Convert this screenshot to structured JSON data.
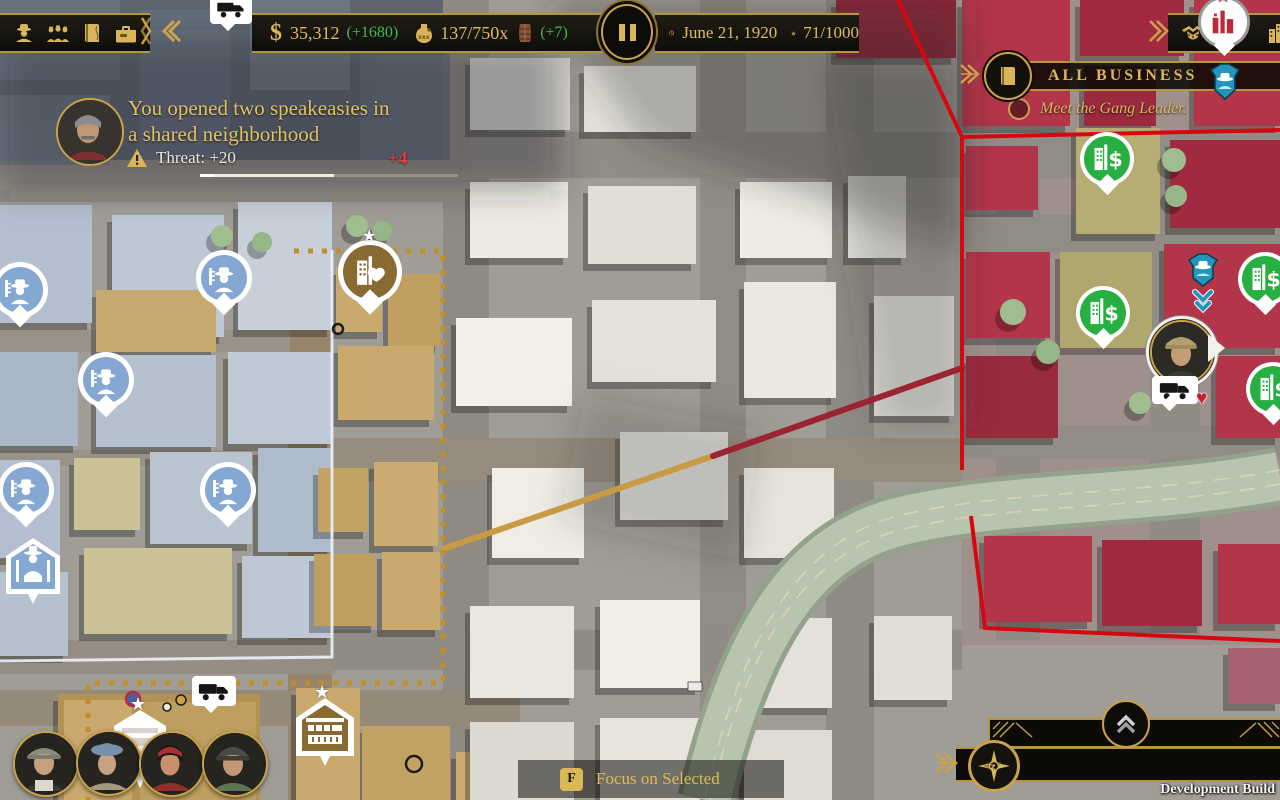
{
  "colors": {
    "gold": "#d4b056",
    "gold_bright": "#eacd7e",
    "green": "#43b854",
    "red_delta": "#e23c3c",
    "territory_red": "#d50812",
    "territory_blue": "#e9f0f7",
    "territory_gold": "#c08f2a",
    "pin_blue": "#84a8d2",
    "pin_green": "#27af41",
    "teal": "#2ba3c4"
  },
  "icons": {
    "star": "★",
    "heart": "♥",
    "dollar": "$",
    "warning": "!"
  },
  "top_bar": {
    "money_symbol": "$",
    "money_value": "35,312",
    "money_delta": "(+1680)",
    "booze_value": "137/750x",
    "booze_delta": "(+7)",
    "date": "June 21, 1920",
    "respect": "71/1000"
  },
  "notification": {
    "line1": "You opened two speakeasies in",
    "line2": "a shared neighborhood",
    "threat": "Threat: +20",
    "delta": "+4"
  },
  "objective": {
    "title": "ALL BUSINESS",
    "task": "Meet the Gang Leader."
  },
  "focus_hint": {
    "key": "F",
    "label": "Focus on Selected"
  },
  "footer": {
    "build_label": "Development Build"
  }
}
